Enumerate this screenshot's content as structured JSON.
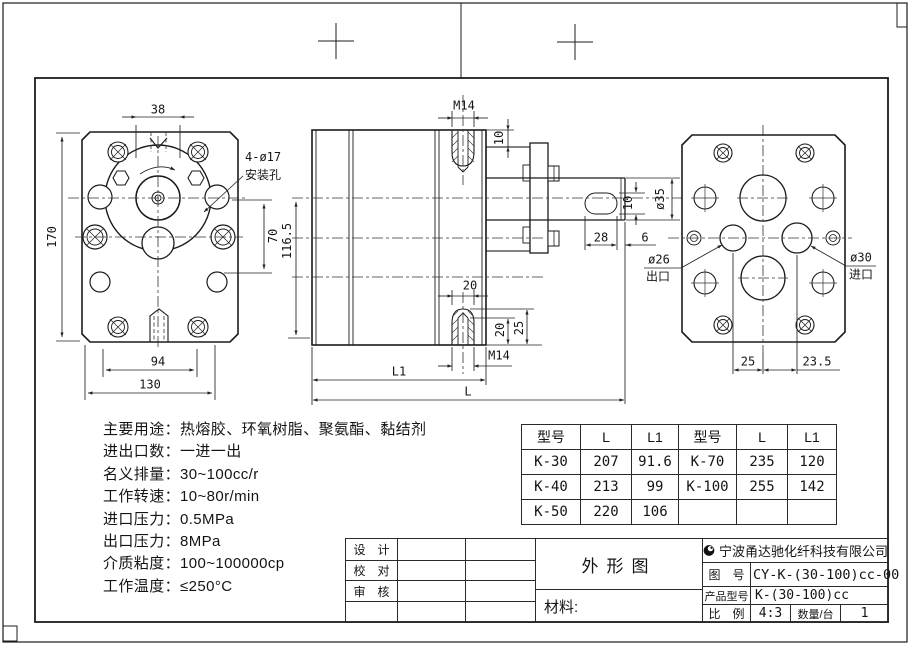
{
  "views": {
    "front": {
      "dim_top_width": "38",
      "dim_height": "170",
      "dim_hole_spacing_v": "70",
      "dim_bolt_spacing": "94",
      "dim_width": "130",
      "mount_holes_line1": "4-ø17",
      "mount_holes_line2": "安装孔"
    },
    "side": {
      "thread_top": "M14",
      "dim_step": "10",
      "dim_height": "116.5",
      "dim_port_width": "20",
      "dim_thread_depth": "20",
      "dim_port_depth": "25",
      "thread_bottom": "M14",
      "dim_l1": "L1",
      "dim_l": "L",
      "dim_key_length": "28",
      "dim_key_to_end": "6",
      "dim_key_width": "10",
      "dim_shaft_dia": "ø35"
    },
    "rear": {
      "outlet_dia": "ø26",
      "outlet_label": "出口",
      "inlet_dia": "ø30",
      "inlet_label": "进口",
      "dim_outlet_offset": "25",
      "dim_inlet_offset": "23.5"
    }
  },
  "specs": {
    "lines": [
      "主要用途：热熔胶、环氧树脂、聚氨酯、黏结剂",
      "进出口数：一进一出",
      "名义排量：30~100cc/r",
      "工作转速：10~80r/min",
      "进口压力：0.5MPa",
      "出口压力：8MPa",
      "介质粘度：100~100000cp",
      "工作温度：≤250°C"
    ]
  },
  "size_tables": {
    "left": {
      "headers": [
        "型号",
        "L",
        "L1"
      ],
      "rows": [
        [
          "K-30",
          "207",
          "91.6"
        ],
        [
          "K-40",
          "213",
          "99"
        ],
        [
          "K-50",
          "220",
          "106"
        ]
      ]
    },
    "right": {
      "headers": [
        "型号",
        "L",
        "L1"
      ],
      "rows": [
        [
          "K-70",
          "235",
          "120"
        ],
        [
          "K-100",
          "255",
          "142"
        ],
        [
          "",
          "",
          ""
        ]
      ]
    }
  },
  "title_block": {
    "sign_rows": [
      "设　计",
      "校　对",
      "审　核"
    ],
    "drawing_title": "外形图",
    "material_label": "材料:",
    "company": "宁波甬达驰化纤科技有限公司",
    "drawing_no_label": "图　号",
    "drawing_no": "CY-K-(30-100)cc-00",
    "product_model_label": "产品型号",
    "product_model": "K-(30-100)cc",
    "scale_label": "比　例",
    "scale": "4:3",
    "qty_label": "数量/台",
    "qty": "1"
  }
}
